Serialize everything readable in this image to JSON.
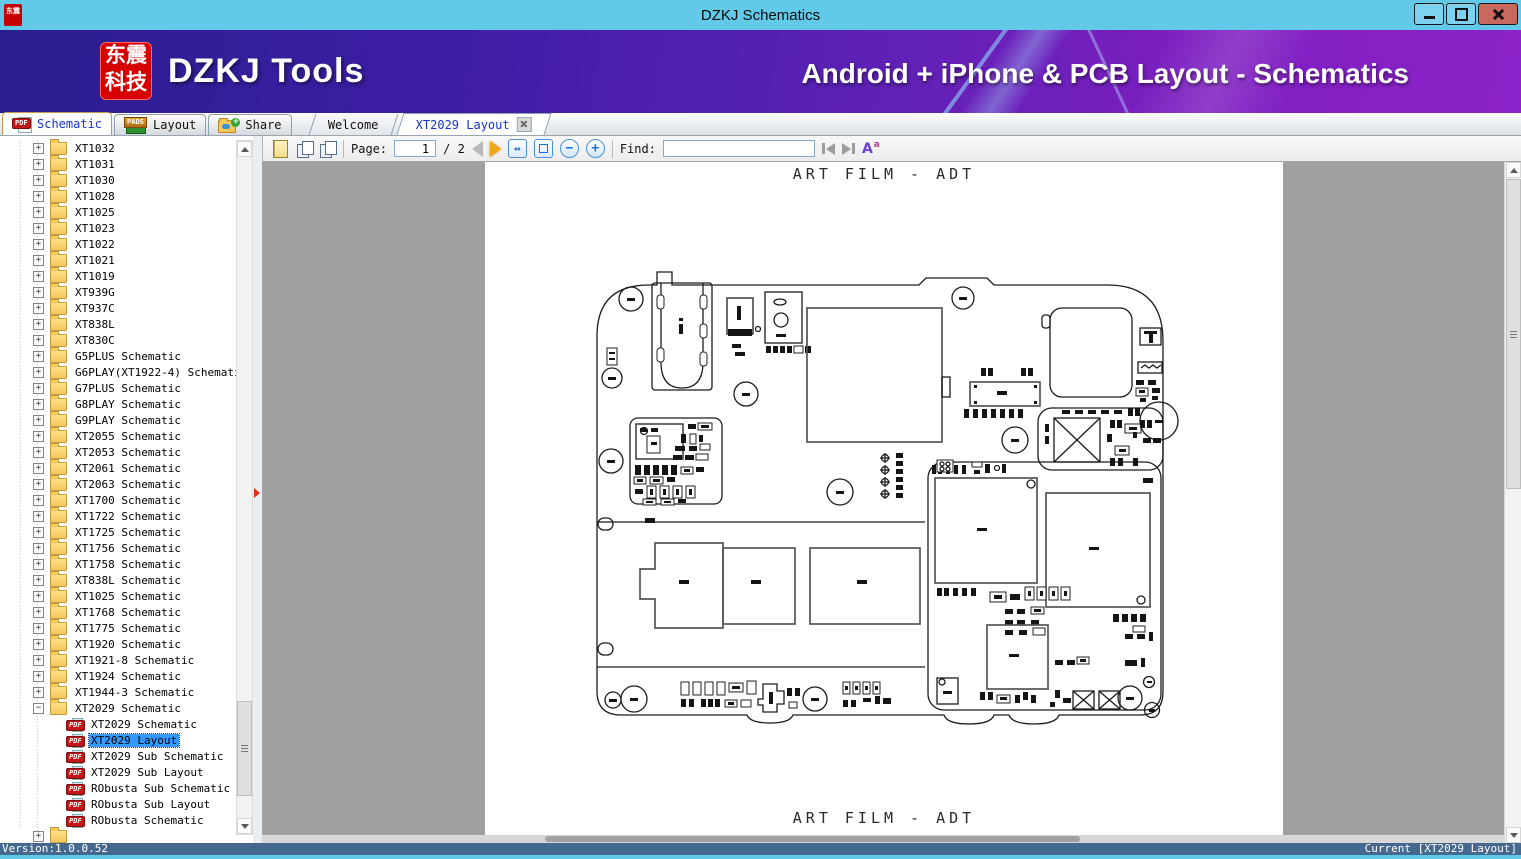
{
  "window": {
    "title": "DZKJ Schematics"
  },
  "banner": {
    "logo_top": "东震",
    "logo_bottom": "科技",
    "product": "DZKJ Tools",
    "tagline": "Android + iPhone & PCB Layout - Schematics"
  },
  "icons": {
    "pdf_badge": "PDF",
    "pads_badge": "PADS"
  },
  "mode_tabs": {
    "schematic": "Schematic",
    "layout": "Layout",
    "share": "Share"
  },
  "doc_tabs": {
    "welcome": "Welcome",
    "current": "XT2029 Layout"
  },
  "toolbar": {
    "page_label": "Page:",
    "page_value": "1",
    "page_total": "/ 2",
    "find_label": "Find:",
    "find_value": ""
  },
  "tree": {
    "folders": [
      "XT1032",
      "XT1031",
      "XT1030",
      "XT1028",
      "XT1025",
      "XT1023",
      "XT1022",
      "XT1021",
      "XT1019",
      "XT939G",
      "XT937C",
      "XT838L",
      "XT830C",
      "G5PLUS Schematic",
      "G6PLAY(XT1922-4) Schematic",
      "G7PLUS Schematic",
      "G8PLAY Schematic",
      "G9PLAY Schematic",
      "XT2055 Schematic",
      "XT2053 Schematic",
      "XT2061 Schematic",
      "XT2063 Schematic",
      "XT1700 Schematic",
      "XT1722 Schematic",
      "XT1725 Schematic",
      "XT1756 Schematic",
      "XT1758 Schematic",
      "XT838L Schematic",
      "XT1025 Schematic",
      "XT1768 Schematic",
      "XT1775 Schematic",
      "XT1920 Schematic",
      "XT1921-8 Schematic",
      "XT1924 Schematic",
      "XT1944-3 Schematic",
      "XT2029 Schematic"
    ],
    "children": [
      "XT2029 Schematic",
      "XT2029 Layout",
      "XT2029 Sub Schematic",
      "XT2029 Sub Layout",
      "RObusta Sub Schematic",
      "RObusta Sub Layout",
      "RObusta Schematic"
    ],
    "selected_child": "XT2029 Layout"
  },
  "document": {
    "page_header": "ART FILM - ADT",
    "page_footer": "ART FILM - ADT"
  },
  "status": {
    "left": "Version:1.0.0.52",
    "right": "Current [XT2029 Layout]"
  },
  "colors": {
    "titlebar": "#63c9e9",
    "banner_start": "#2a1f8e",
    "banner_end": "#8d22c9",
    "accent_red": "#d60000",
    "status_bar": "#45688e",
    "selection": "#3399ff"
  }
}
